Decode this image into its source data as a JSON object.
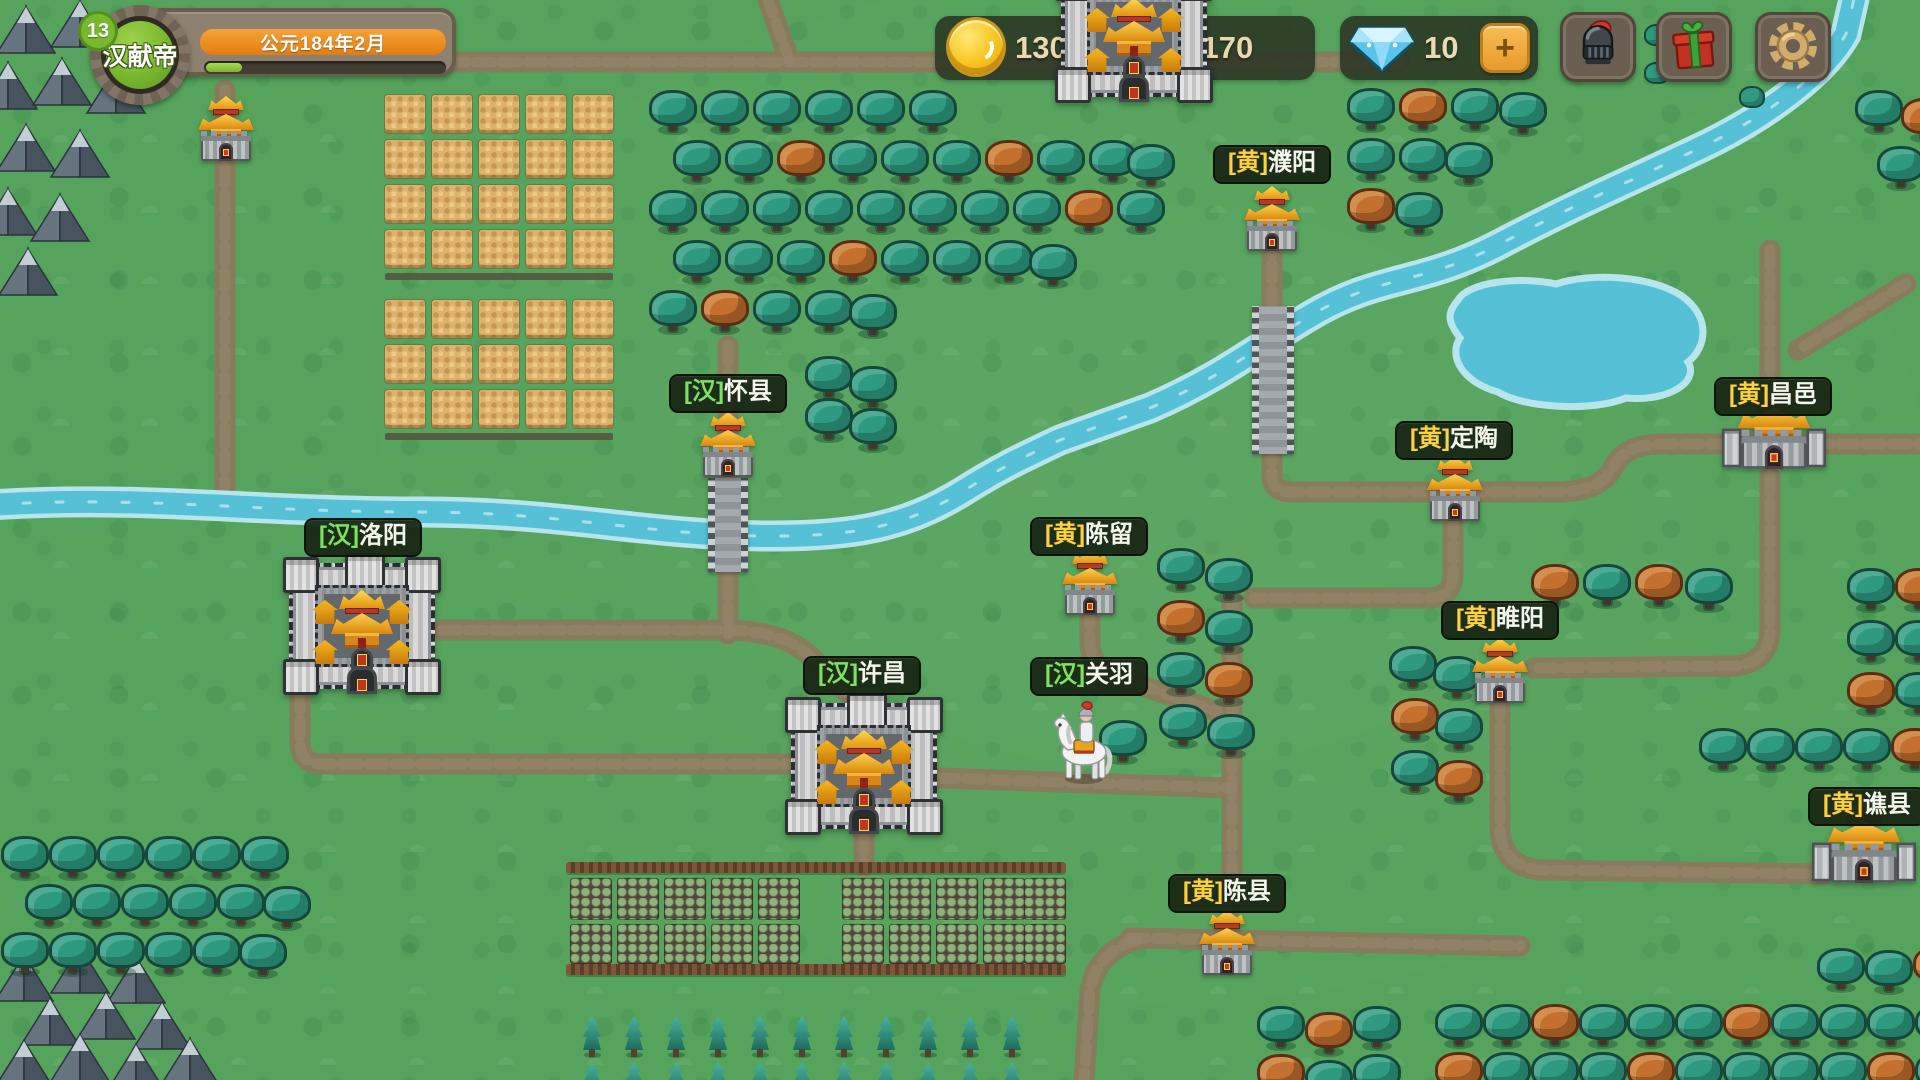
{
  "hud": {
    "player": {
      "level": "13",
      "name": "汉献帝",
      "date": "公元184年2月",
      "xp_percent": 15
    },
    "resources": {
      "gold": "1300",
      "clover": "1170",
      "gems": "10",
      "add_label": "+"
    },
    "actions": [
      {
        "id": "hero",
        "icon": "helmet-icon"
      },
      {
        "id": "gift",
        "icon": "gift-icon"
      },
      {
        "id": "settings",
        "icon": "gear-icon"
      }
    ]
  },
  "factions": {
    "han": {
      "tag": "[汉]",
      "color": "#7de35f"
    },
    "yellow": {
      "tag": "[黄]",
      "color": "#ffd23c"
    }
  },
  "colors": {
    "grass": "#56a35d",
    "road": "#897a5c",
    "water": "#55c0d6",
    "label_bg": "#18261466",
    "accent_orange": "#e9891c",
    "xp_green": "#8dc63f",
    "gold_text": "#ead9ae"
  },
  "map": {
    "settlements": [
      {
        "id": "puyang",
        "kind": "town",
        "tag": "[黄]",
        "faction": "yellow",
        "name": "濮阳",
        "x": 1244,
        "y": 186,
        "label_x": 1272,
        "label_y": 145
      },
      {
        "id": "huaixian",
        "kind": "town",
        "tag": "[汉]",
        "faction": "han",
        "name": "怀县",
        "x": 700,
        "y": 412,
        "label_x": 728,
        "label_y": 374
      },
      {
        "id": "chenliu",
        "kind": "town",
        "tag": "[黄]",
        "faction": "yellow",
        "name": "陈留",
        "x": 1062,
        "y": 550,
        "label_x": 1089,
        "label_y": 517
      },
      {
        "id": "dingtao",
        "kind": "town",
        "tag": "[黄]",
        "faction": "yellow",
        "name": "定陶",
        "x": 1427,
        "y": 456,
        "label_x": 1454,
        "label_y": 421
      },
      {
        "id": "suiyang",
        "kind": "town",
        "tag": "[黄]",
        "faction": "yellow",
        "name": "睢阳",
        "x": 1472,
        "y": 638,
        "label_x": 1500,
        "label_y": 601
      },
      {
        "id": "chenxian",
        "kind": "town",
        "tag": "[黄]",
        "faction": "yellow",
        "name": "陈县",
        "x": 1199,
        "y": 910,
        "label_x": 1227,
        "label_y": 874
      },
      {
        "id": "northtown",
        "kind": "town",
        "tag": "",
        "faction": "",
        "name": "",
        "x": 198,
        "y": 96
      },
      {
        "id": "changyi",
        "kind": "bigtown",
        "tag": "[黄]",
        "faction": "yellow",
        "name": "昌邑",
        "x": 1746,
        "y": 404,
        "label_x": 1773,
        "label_y": 377
      },
      {
        "id": "qiaoxian",
        "kind": "bigtown",
        "tag": "[黄]",
        "faction": "yellow",
        "name": "谯县",
        "x": 1836,
        "y": 818,
        "label_x": 1867,
        "label_y": 787
      },
      {
        "id": "luoyang",
        "kind": "city",
        "tag": "[汉]",
        "faction": "han",
        "name": "洛阳",
        "x": 284,
        "y": 558,
        "label_x": 363,
        "label_y": 518
      },
      {
        "id": "xuchang",
        "kind": "city",
        "tag": "[汉]",
        "faction": "han",
        "name": "许昌",
        "x": 786,
        "y": 698,
        "label_x": 862,
        "label_y": 656
      },
      {
        "id": "topcity",
        "kind": "city",
        "tag": "",
        "faction": "",
        "name": "",
        "x": 1056,
        "y": -34,
        "top": true
      }
    ],
    "character": {
      "id": "guanyu",
      "tag": "[汉]",
      "faction": "han",
      "name": "关羽",
      "x": 1048,
      "y": 700,
      "label_x": 1089,
      "label_y": 657
    },
    "decor": {
      "rivers": [
        "M-10 505 C140 495 250 512 420 512 C560 512 640 534 762 536 C856 537 906 526 962 492 C1000 468 1022 458 1060 440 L1150 408 C1220 378 1262 344 1310 316 C1380 274 1420 286 1500 244 C1580 202 1620 186 1700 148 C1772 114 1826 70 1846 34 L1856 -10"
      ],
      "lake": "M1458 300 C1468 282 1520 276 1556 284 C1592 272 1652 276 1682 296 C1712 318 1706 348 1688 362 C1700 382 1668 402 1626 398 C1592 412 1524 408 1498 392 C1462 382 1448 356 1460 338 C1446 320 1448 312 1458 300 Z",
      "roads": [
        "M225 90 L225 487",
        "M372 62 L1400 62",
        "M790 62 L768 0",
        "M1272 238 L1272 476 Q1272 492 1292 492 L1556 492 Q1602 492 1614 466 Q1626 444 1662 444 L1920 444",
        "M1770 250 L1770 410",
        "M1906 284 L1798 350",
        "M1770 476 L1770 628 Q1770 662 1736 666 L1534 668",
        "M1500 700 L1500 826 Q1500 866 1540 870 L1824 874",
        "M1453 518 L1453 574 Q1453 598 1428 598 L1254 598",
        "M1232 598 L1232 906",
        "M1090 610 L1090 642 Q1090 666 1114 676 L1218 712",
        "M300 694 L300 742 Q300 764 322 764 L788 764",
        "M442 630 L724 630 Q786 630 814 660 L846 692",
        "M728 346 L728 634",
        "M940 778 L1232 788",
        "M864 836 L864 866",
        "M1130 938 L1520 946",
        "M1138 940 Q1098 950 1090 990 L1084 1080"
      ],
      "bridges": [
        {
          "x": 708,
          "y": 478,
          "w": 40,
          "h": 94
        },
        {
          "x": 1252,
          "y": 306,
          "w": 42,
          "h": 148
        }
      ],
      "mountains": [
        [
          26,
          30
        ],
        [
          80,
          24
        ],
        [
          134,
          32
        ],
        [
          8,
          86
        ],
        [
          62,
          82
        ],
        [
          116,
          90
        ],
        [
          26,
          148
        ],
        [
          80,
          154
        ],
        [
          8,
          212
        ],
        [
          60,
          218
        ],
        [
          28,
          272
        ],
        [
          24,
          978
        ],
        [
          80,
          970
        ],
        [
          136,
          980
        ],
        [
          50,
          1022
        ],
        [
          106,
          1016
        ],
        [
          162,
          1026
        ],
        [
          24,
          1064
        ],
        [
          80,
          1058
        ],
        [
          136,
          1068
        ],
        [
          190,
          1062
        ]
      ],
      "wheat": {
        "tile_w": 40,
        "tile_h": 38,
        "gap": 7,
        "blocks": [
          {
            "x": 385,
            "y": 95,
            "cols": 5,
            "rows": 4
          },
          {
            "x": 385,
            "y": 300,
            "cols": 5,
            "rows": 3
          }
        ]
      },
      "farm": {
        "fences": [
          {
            "x": 566,
            "y": 862,
            "w": 500
          },
          {
            "x": 566,
            "y": 964,
            "w": 500
          }
        ],
        "crop_rows": [
          {
            "y": 878,
            "h": 42
          },
          {
            "y": 924,
            "h": 40
          }
        ],
        "crop_xs": [
          570,
          617,
          664,
          711,
          758,
          842,
          889,
          936,
          983,
          1024
        ],
        "crop_w": 42
      },
      "pines": {
        "rows": [
          1016,
          1062
        ],
        "xs": [
          583,
          625,
          667,
          709,
          751,
          793,
          835,
          877,
          919,
          961,
          1003
        ]
      },
      "trees": [
        [
          650,
          92
        ],
        [
          702,
          92
        ],
        [
          754,
          92
        ],
        [
          806,
          92
        ],
        [
          858,
          92
        ],
        [
          910,
          92
        ],
        [
          674,
          142
        ],
        [
          726,
          142
        ],
        [
          778,
          142,
          1
        ],
        [
          830,
          142
        ],
        [
          882,
          142
        ],
        [
          934,
          142
        ],
        [
          986,
          142,
          1
        ],
        [
          1038,
          142
        ],
        [
          1090,
          142
        ],
        [
          1128,
          146
        ],
        [
          650,
          192
        ],
        [
          702,
          192
        ],
        [
          754,
          192
        ],
        [
          806,
          192
        ],
        [
          858,
          192
        ],
        [
          910,
          192
        ],
        [
          962,
          192
        ],
        [
          1014,
          192
        ],
        [
          1066,
          192,
          1
        ],
        [
          1118,
          192
        ],
        [
          674,
          242
        ],
        [
          726,
          242
        ],
        [
          778,
          242
        ],
        [
          830,
          242,
          1
        ],
        [
          882,
          242
        ],
        [
          934,
          242
        ],
        [
          986,
          242
        ],
        [
          1030,
          246
        ],
        [
          650,
          292
        ],
        [
          702,
          292,
          1
        ],
        [
          754,
          292
        ],
        [
          806,
          292
        ],
        [
          850,
          296
        ],
        [
          1348,
          90
        ],
        [
          1400,
          90,
          1
        ],
        [
          1452,
          90
        ],
        [
          1500,
          94
        ],
        [
          1348,
          140
        ],
        [
          1400,
          140
        ],
        [
          1446,
          144
        ],
        [
          1348,
          190,
          1
        ],
        [
          1396,
          194
        ],
        [
          1856,
          92
        ],
        [
          1902,
          100,
          1
        ],
        [
          1878,
          148
        ],
        [
          1532,
          566,
          1
        ],
        [
          1584,
          566
        ],
        [
          1636,
          566,
          1
        ],
        [
          1686,
          570
        ],
        [
          1390,
          648
        ],
        [
          1434,
          658
        ],
        [
          1392,
          700,
          1
        ],
        [
          1436,
          710
        ],
        [
          1392,
          752
        ],
        [
          1436,
          762,
          1
        ],
        [
          1848,
          570
        ],
        [
          1896,
          570,
          1
        ],
        [
          1848,
          622
        ],
        [
          1896,
          622
        ],
        [
          1848,
          674,
          1
        ],
        [
          1896,
          674
        ],
        [
          1700,
          730
        ],
        [
          1748,
          730
        ],
        [
          1796,
          730
        ],
        [
          1844,
          730
        ],
        [
          1892,
          730,
          1
        ],
        [
          1158,
          550
        ],
        [
          1206,
          560
        ],
        [
          1158,
          602,
          1
        ],
        [
          1206,
          612
        ],
        [
          1158,
          654
        ],
        [
          1206,
          664,
          1
        ],
        [
          1160,
          706
        ],
        [
          1100,
          722
        ],
        [
          1208,
          716
        ],
        [
          806,
          358
        ],
        [
          850,
          368
        ],
        [
          806,
          400
        ],
        [
          850,
          410
        ],
        [
          2,
          838
        ],
        [
          50,
          838
        ],
        [
          98,
          838
        ],
        [
          146,
          838
        ],
        [
          194,
          838
        ],
        [
          242,
          838
        ],
        [
          26,
          886
        ],
        [
          74,
          886
        ],
        [
          122,
          886
        ],
        [
          170,
          886
        ],
        [
          218,
          886
        ],
        [
          264,
          888
        ],
        [
          2,
          934
        ],
        [
          50,
          934
        ],
        [
          98,
          934
        ],
        [
          146,
          934
        ],
        [
          194,
          934
        ],
        [
          240,
          936
        ],
        [
          1258,
          1008
        ],
        [
          1306,
          1014,
          1
        ],
        [
          1354,
          1008
        ],
        [
          1258,
          1056,
          1
        ],
        [
          1306,
          1062
        ],
        [
          1354,
          1056
        ],
        [
          1818,
          950
        ],
        [
          1866,
          952
        ],
        [
          1914,
          948,
          1
        ],
        [
          1436,
          1006
        ],
        [
          1484,
          1006
        ],
        [
          1532,
          1006,
          1
        ],
        [
          1580,
          1006
        ],
        [
          1628,
          1006
        ],
        [
          1676,
          1006
        ],
        [
          1724,
          1006,
          1
        ],
        [
          1772,
          1006
        ],
        [
          1820,
          1006
        ],
        [
          1868,
          1006
        ],
        [
          1916,
          1006
        ],
        [
          1436,
          1054,
          1
        ],
        [
          1484,
          1054
        ],
        [
          1532,
          1054
        ],
        [
          1580,
          1054
        ],
        [
          1628,
          1054,
          1
        ],
        [
          1676,
          1054
        ],
        [
          1724,
          1054
        ],
        [
          1772,
          1054
        ],
        [
          1820,
          1054
        ],
        [
          1868,
          1054,
          1
        ],
        [
          1916,
          1054
        ],
        [
          1645,
          24,
          2
        ],
        [
          1645,
          62,
          2
        ],
        [
          1740,
          86,
          2
        ]
      ]
    }
  }
}
